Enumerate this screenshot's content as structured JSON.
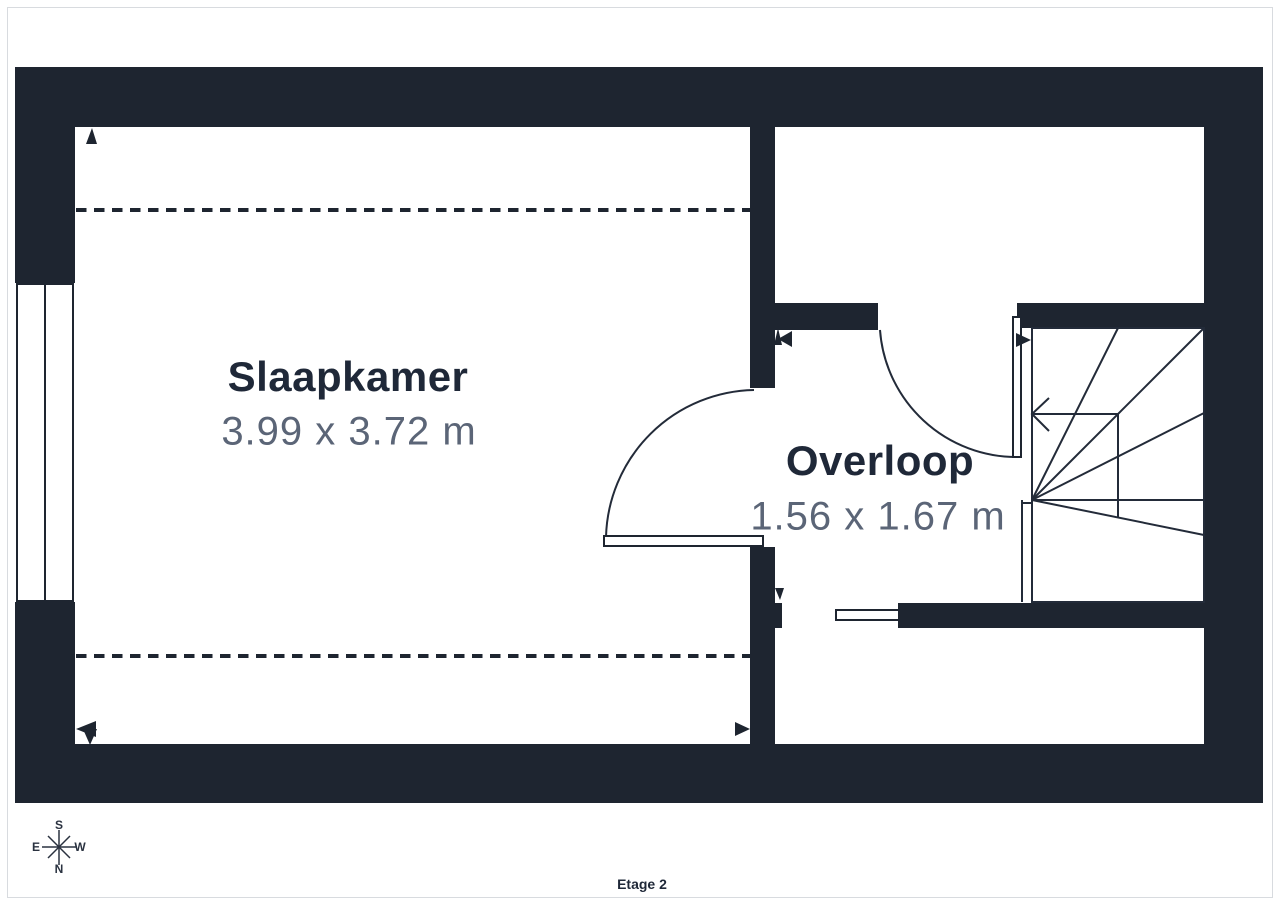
{
  "floor_label": "Etage 2",
  "rooms": [
    {
      "name": "Slaapkamer",
      "dimensions": "3.99 x 3.72 m"
    },
    {
      "name": "Overloop",
      "dimensions": "1.56 x 1.67 m"
    }
  ],
  "compass": {
    "top": "S",
    "left": "E",
    "right": "W",
    "bottom": "N"
  },
  "colors": {
    "wall": "#1e2530",
    "line": "#232b39",
    "title_text": "#1f2838",
    "dim_text": "#5b6577",
    "compass": "#2a3240",
    "page_border": "#d8dbdf",
    "page_background": "#ffffff"
  }
}
